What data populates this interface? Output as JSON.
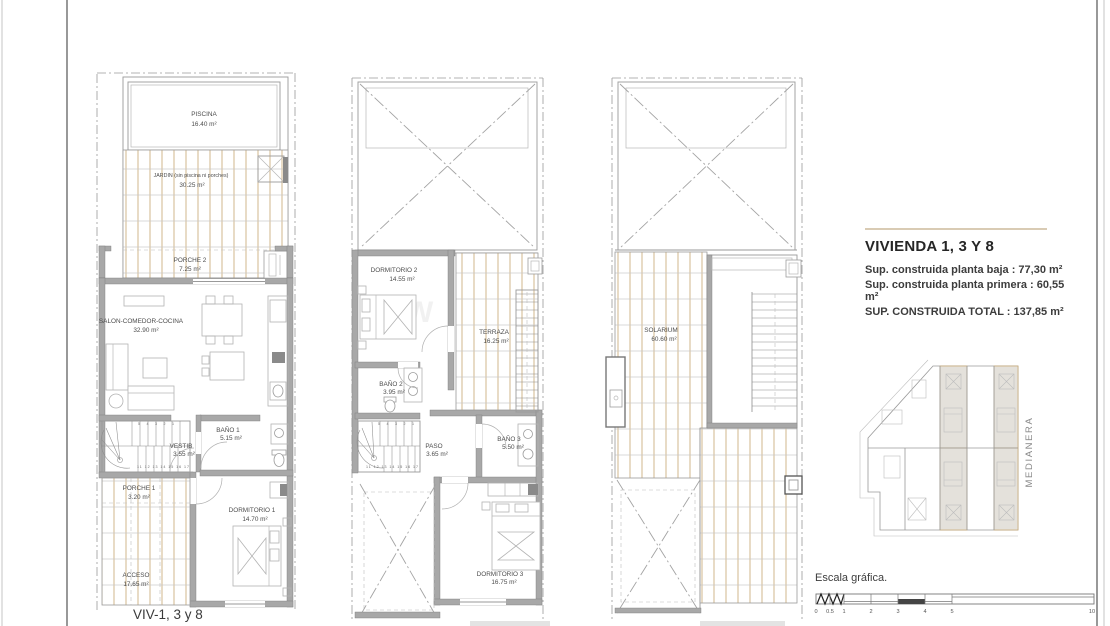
{
  "plans": {
    "ground": {
      "caption": "VIV-1, 3 y 8",
      "rooms": {
        "piscina": {
          "name": "PISCINA",
          "area": "16.40 m²"
        },
        "jardin": {
          "name": "JARDIN (sin piscina ni porches)",
          "area": "30.25 m²"
        },
        "porche2": {
          "name": "PORCHE 2",
          "area": "7.25 m²"
        },
        "salon": {
          "name": "SALON-COMEDOR-COCINA",
          "area": "32.90 m²"
        },
        "bano1": {
          "name": "BAÑO 1",
          "area": "5.15 m²"
        },
        "vestibulo": {
          "name": "VESTIB",
          "area": "3.55 m²"
        },
        "porche1": {
          "name": "PORCHE 1",
          "area": "3.20 m²"
        },
        "dormitorio1": {
          "name": "DORMITORIO 1",
          "area": "14.70 m²"
        },
        "acceso": {
          "name": "ACCESO",
          "area": "17.65 m²"
        }
      },
      "stair_numbers": {
        "top": "5 4 3 2 1",
        "bottom": "11 12 13 14 15 16 17"
      }
    },
    "first": {
      "rooms": {
        "dormitorio2": {
          "name": "DORMITORIO 2",
          "area": "14.55 m²"
        },
        "terraza": {
          "name": "TERRAZA",
          "area": "16.25 m²"
        },
        "bano2": {
          "name": "BAÑO 2",
          "area": "3.95 m²"
        },
        "paso": {
          "name": "PASO",
          "area": "3.65 m²"
        },
        "bano3": {
          "name": "BAÑO 3",
          "area": "5.50 m²"
        },
        "dormitorio3": {
          "name": "DORMITORIO 3",
          "area": "16.75 m²"
        }
      },
      "stair_numbers": {
        "top": "5 4 3 2 1",
        "bottom": "11 12 13 14 15 16 17"
      }
    },
    "roof": {
      "rooms": {
        "solarium": {
          "name": "SOLARIUM",
          "area": "60.60 m²"
        }
      }
    }
  },
  "info_block": {
    "title": "VIVIENDA 1, 3 Y 8",
    "lines": [
      "Sup. construida planta baja : 77,30 m²",
      "Sup. construida planta primera : 60,55 m²",
      "SUP. CONSTRUIDA TOTAL : 137,85 m²"
    ]
  },
  "key_plan": {
    "side_label": "MEDIANERA"
  },
  "scale_bar": {
    "label": "Escala gráfica.",
    "ticks": [
      "0",
      "0.5",
      "1",
      "2",
      "3",
      "4",
      "5",
      "10"
    ]
  },
  "watermark": {
    "text": "W"
  },
  "colors": {
    "hatch_tan": "#c7a56e",
    "hatch_grey": "#c9c9c9",
    "wall_grey": "#a8a8a8",
    "accent_rule": "#d9cbb4",
    "text_dark": "#262626",
    "text_label": "#4d4d4d"
  }
}
